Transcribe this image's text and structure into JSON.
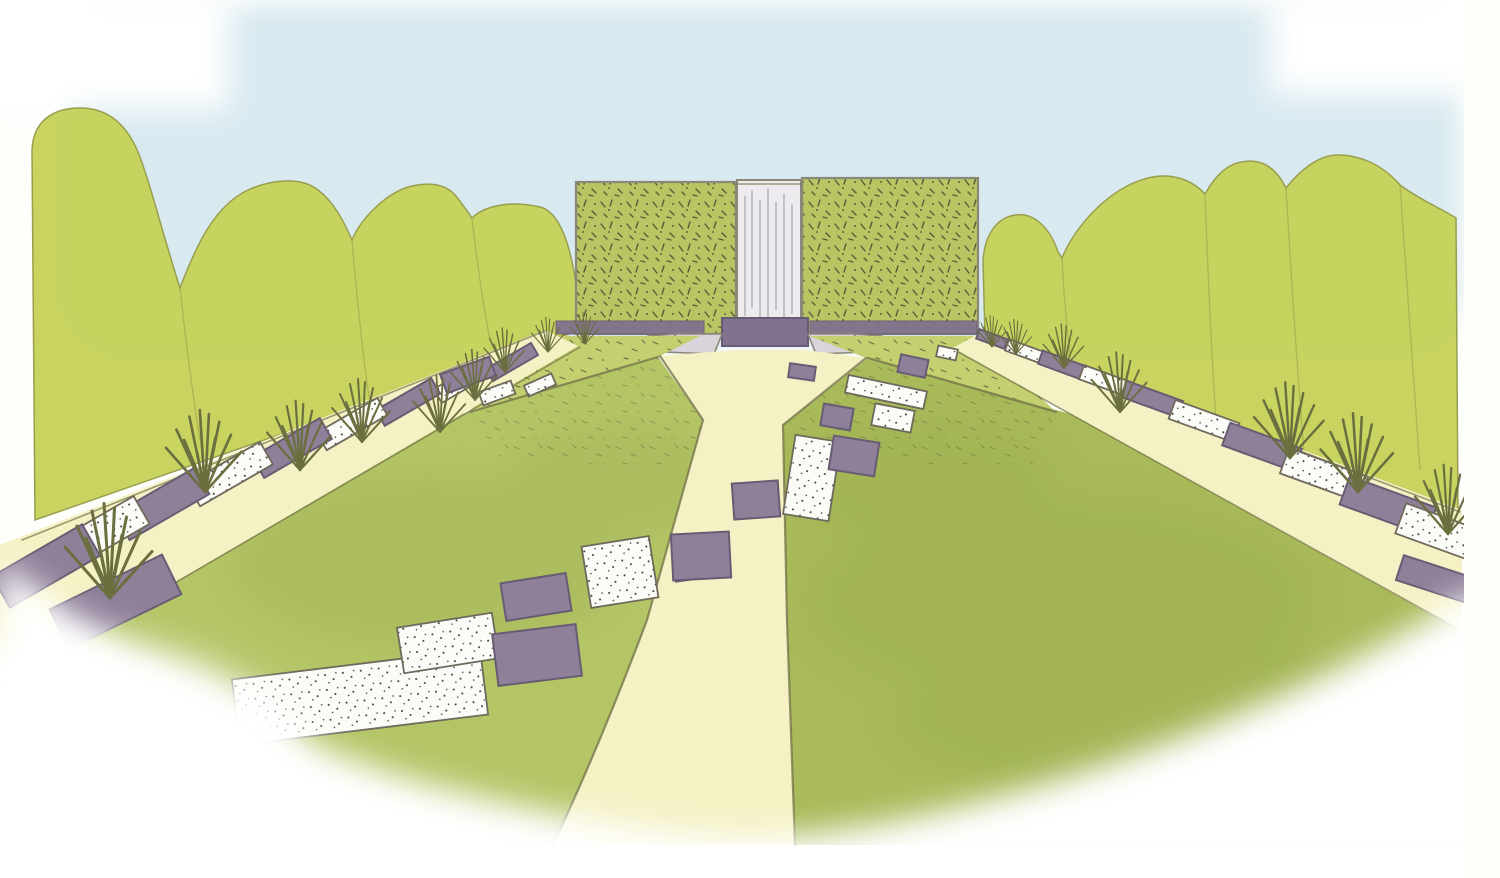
{
  "scene": {
    "sky": "Sky",
    "trees": "Trees",
    "hedge": "Clipped hedge screen",
    "waterfall": "Waterfall",
    "basin": "Water basin",
    "steps": "Stone steps",
    "far_lawn": "Meadow grass",
    "lawn": "Lawn",
    "side_path": "Mown side path",
    "central_path": "Central path",
    "slabs": "Paving slabs",
    "grasses": "Ornamental grasses"
  },
  "colors": {
    "paper": "#fefefb",
    "sky": "#d8e9f0",
    "tree": "#c7d35d",
    "tree_line": "#979d4b",
    "hedge": "#b9c463",
    "hedge_speckle": "#45482f",
    "outline": "#8b887a",
    "far_lawn": "#c4d070",
    "stipple": "#565a3c",
    "lawn_left": "#b4c566",
    "lawn_right": "#a8ba59",
    "lawn_shade": "#93a548",
    "path": "#f4f1c4",
    "path_edge": "#75744b",
    "slab_purple": "#8f8099",
    "slab_purple_edge": "#675c74",
    "slab_white": "#fbfbf7",
    "slab_white_edge": "#6f695c",
    "slab_speckle": "#3a3a35",
    "waterfall": "#edebee",
    "waterfall_streak": "#b2acb8",
    "basin": "#81728f",
    "step": "#d9d4da",
    "grass": "#6b6e3e",
    "fade": "#ffffff"
  }
}
